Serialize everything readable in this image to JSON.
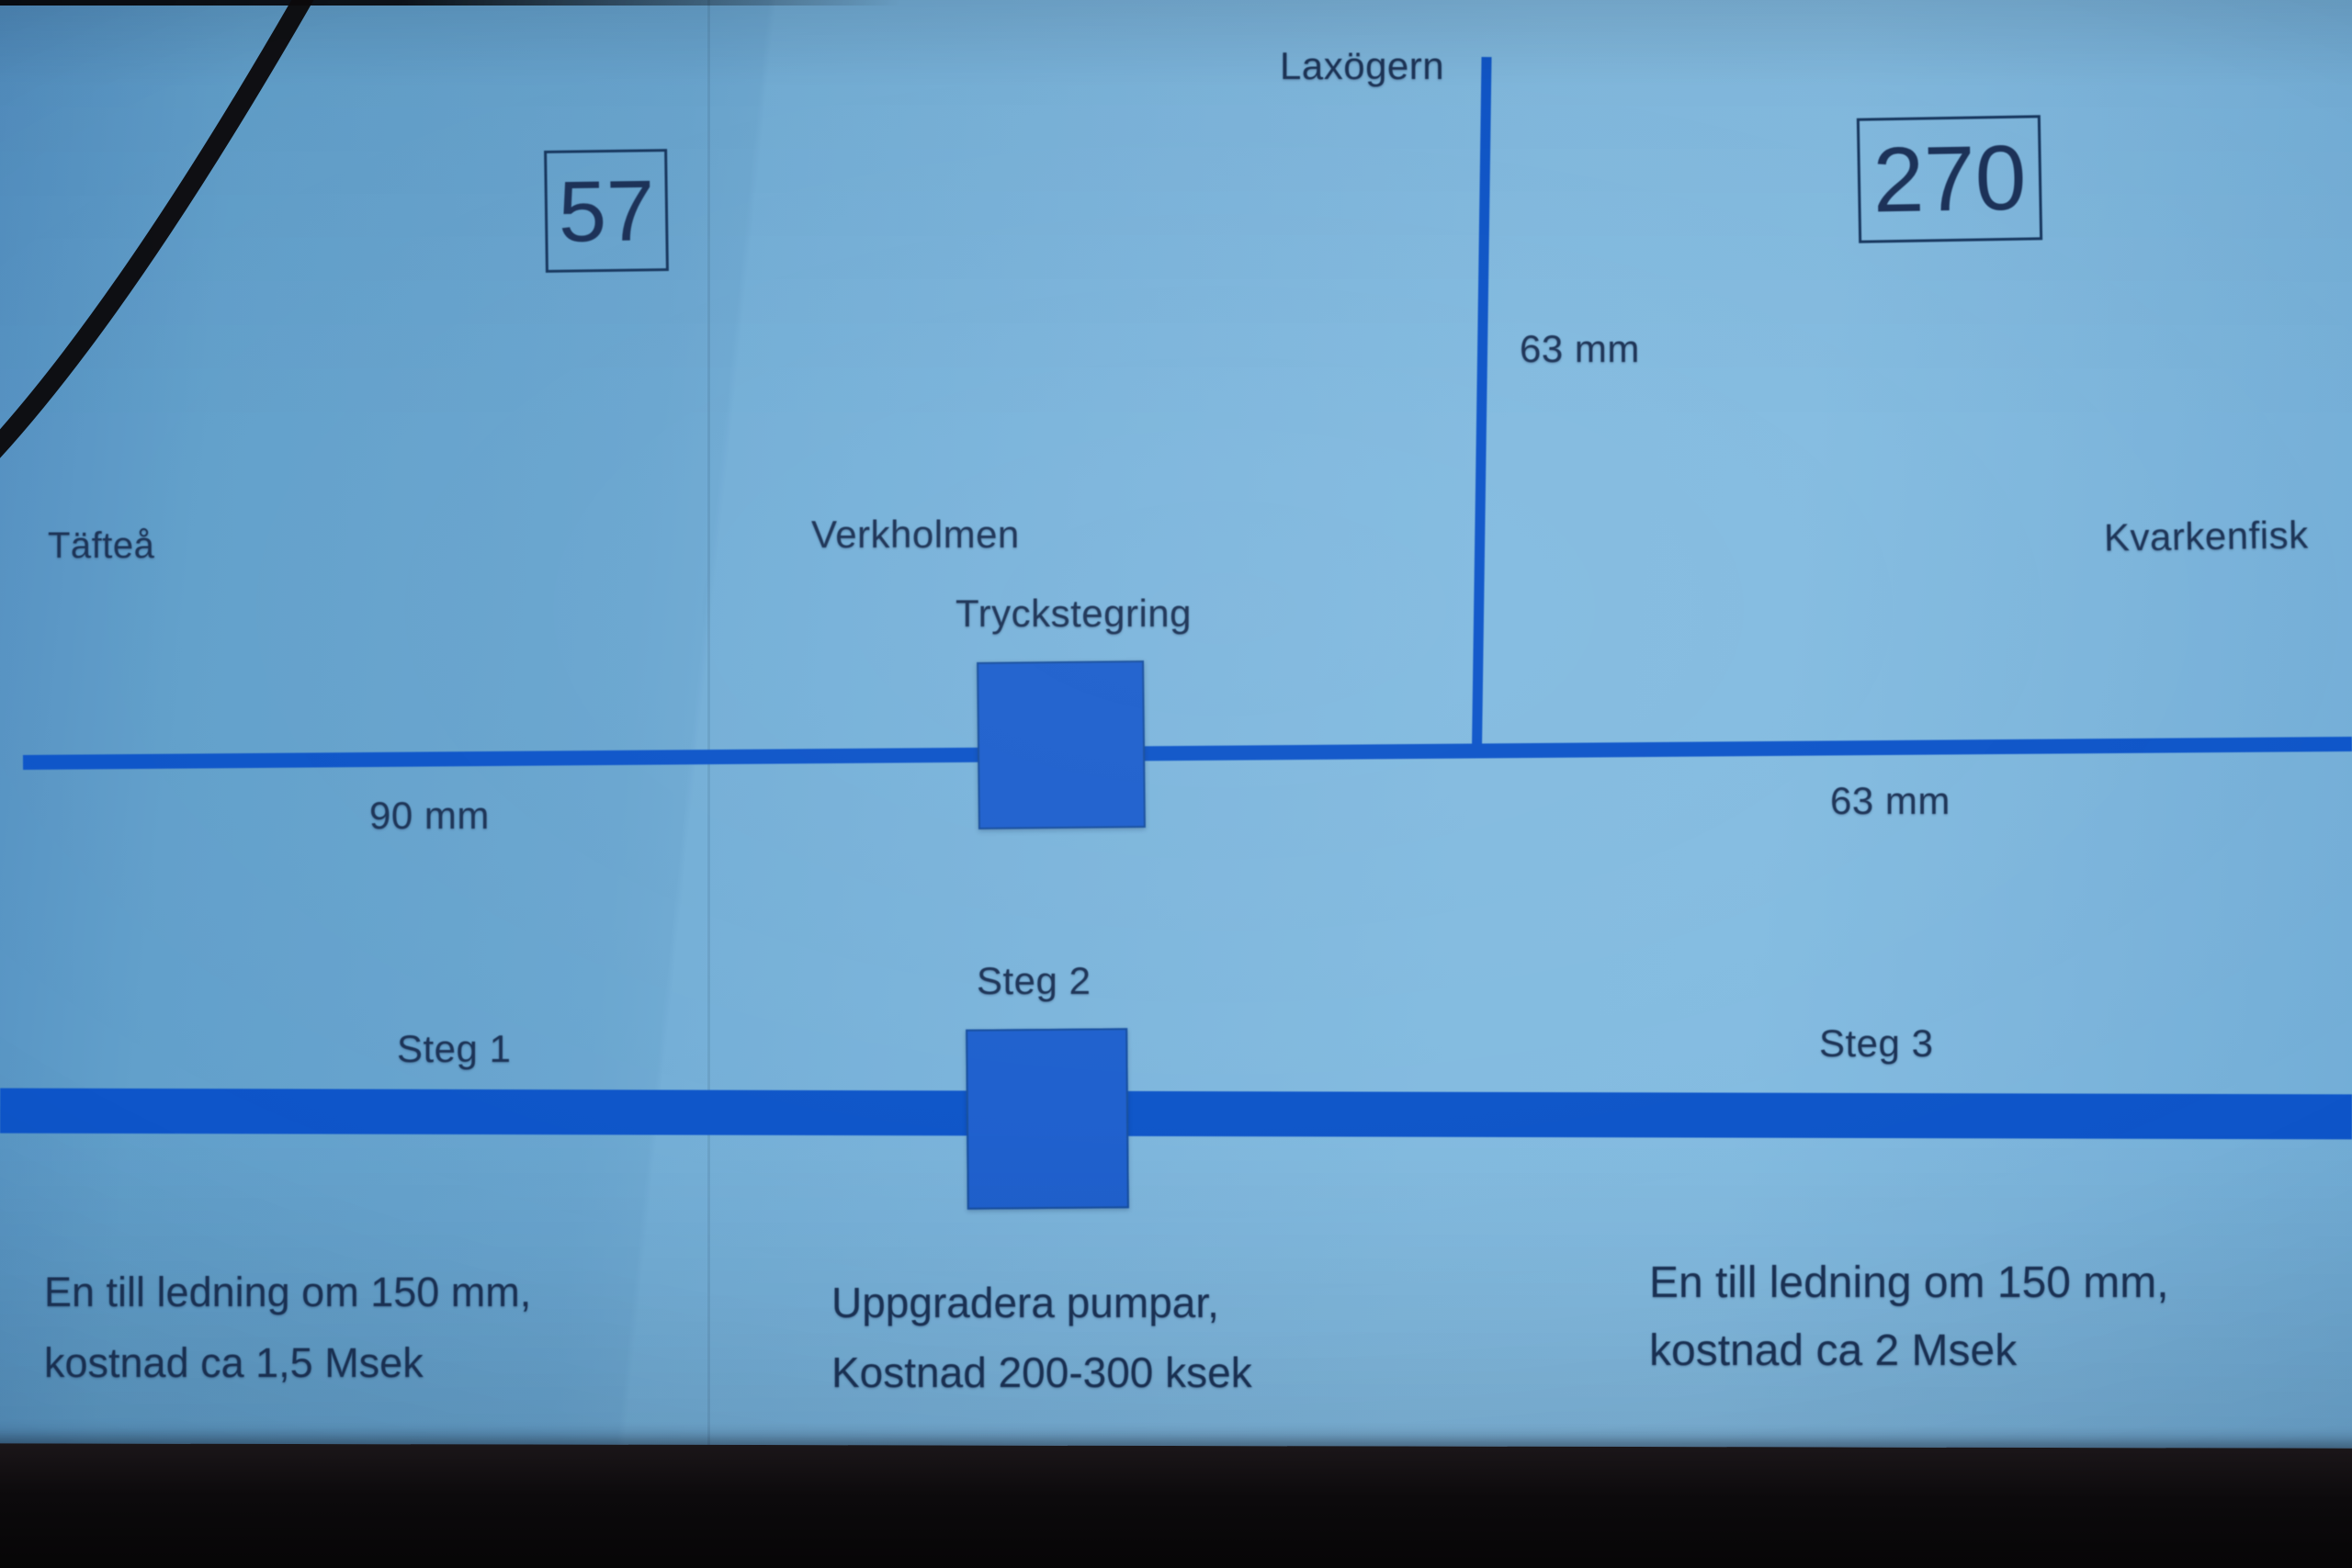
{
  "upper_diagram": {
    "box_left_value": "57",
    "box_right_value": "270",
    "label_laxogern": "Laxögern",
    "label_tafteo": "Täfteå",
    "label_verkholmen": "Verkholmen",
    "label_tryckstegring": "Tryckstegring",
    "label_kvarkenfisk": "Kvarkenfisk",
    "riser_dimension": "63 mm",
    "pipe_left_dimension": "90 mm",
    "pipe_right_dimension": "63 mm"
  },
  "lower_diagram": {
    "steg1": "Steg 1",
    "steg2": "Steg 2",
    "steg3": "Steg 3",
    "note_left": [
      "En till ledning om 150 mm,",
      "kostnad ca 1,5 Msek"
    ],
    "note_mid": [
      "Uppgradera pumpar,",
      "Kostnad 200-300 ksek"
    ],
    "note_right": [
      "En till ledning om 150 mm,",
      "kostnad ca 2 Msek"
    ]
  },
  "colors": {
    "pipe_blue": "#0e55c9",
    "pump_fill": "#1e60ce",
    "box_border_navy": "#16365e",
    "text_navy": "#1c3356",
    "slide_background": "#74afd7",
    "bezel_black": "#0c0a0c"
  }
}
